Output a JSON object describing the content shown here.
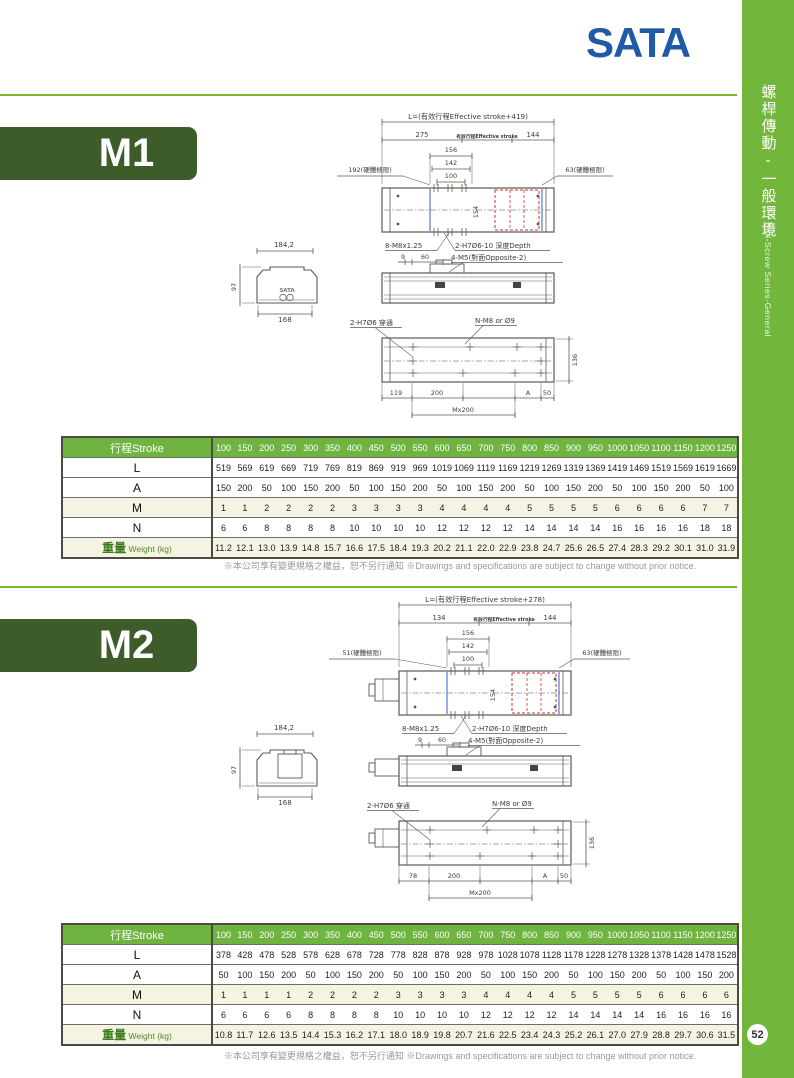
{
  "brand": {
    "logo_text": "SATA",
    "logo_color": "#1e5aa8"
  },
  "sidebar": {
    "series_title_cn": "螺桿傳動-一般環境",
    "series_title_en": "Ball-Screw Series-General",
    "page_number": "52",
    "bg_color": "#72b63c"
  },
  "footnote": "※本公司享有變更規格之權益，恕不另行通知 ※Drawings and specifications are subject to change without prior notice.",
  "table": {
    "header_label": "行程Stroke",
    "stroke_columns": [
      "100",
      "150",
      "200",
      "250",
      "300",
      "350",
      "400",
      "450",
      "500",
      "550",
      "600",
      "650",
      "700",
      "750",
      "800",
      "850",
      "900",
      "950",
      "1000",
      "1050",
      "1100",
      "1150",
      "1200",
      "1250"
    ],
    "weight_label_cn": "重量",
    "weight_label_en": "Weight (kg)"
  },
  "sections": [
    {
      "model": "M1",
      "drawing": {
        "overall_length": "L=(有效行程Effective stroke+419)",
        "front_offset": "275",
        "effective_stroke": "有效行程Effective stroke",
        "rear_offset": "144",
        "carriage_156": "156",
        "carriage_142": "142",
        "carriage_100": "100",
        "left_hard_limit": "192(硬體極限)",
        "right_hard_limit": "63(硬體極限)",
        "width_154": "154",
        "screws_8m8": "8-M8x1.25",
        "pin_holes_depth": "2-H7Ø6-10 深度Depth",
        "dim_9": "9",
        "dim_60": "60",
        "side_screws": "4-M5(對面Opposite-2)",
        "section_width": "184,2",
        "section_height": "97",
        "section_base": "168",
        "brand_mark": "SATA",
        "pin_through": "2-H7Ø6 穿通",
        "mount_holes": "N-M8 or Ø9",
        "base_width_136": "136",
        "first_hole": "119",
        "pitch_200": "200",
        "dim_A": "A",
        "dim_50": "50",
        "pitch_total": "Mx200"
      },
      "rows": [
        {
          "label": "L",
          "values": [
            519,
            569,
            619,
            669,
            719,
            769,
            819,
            869,
            919,
            969,
            1019,
            1069,
            1119,
            1169,
            1219,
            1269,
            1319,
            1369,
            1419,
            1469,
            1519,
            1569,
            1619,
            1669
          ]
        },
        {
          "label": "A",
          "values": [
            150,
            200,
            50,
            100,
            150,
            200,
            50,
            100,
            150,
            200,
            50,
            100,
            150,
            200,
            50,
            100,
            150,
            200,
            50,
            100,
            150,
            200,
            50,
            100
          ]
        },
        {
          "label": "M",
          "values": [
            1,
            1,
            2,
            2,
            2,
            2,
            3,
            3,
            3,
            3,
            4,
            4,
            4,
            4,
            5,
            5,
            5,
            5,
            6,
            6,
            6,
            6,
            7,
            7
          ]
        },
        {
          "label": "N",
          "values": [
            6,
            6,
            8,
            8,
            8,
            8,
            10,
            10,
            10,
            10,
            12,
            12,
            12,
            12,
            14,
            14,
            14,
            14,
            16,
            16,
            16,
            16,
            18,
            18
          ]
        },
        {
          "label": "weight",
          "values": [
            "11.2",
            "12.1",
            "13.0",
            "13.9",
            "14.8",
            "15.7",
            "16.6",
            "17.5",
            "18.4",
            "19.3",
            "20.2",
            "21.1",
            "22.0",
            "22.9",
            "23.8",
            "24.7",
            "25.6",
            "26.5",
            "27.4",
            "28.3",
            "29.2",
            "30.1",
            "31.0",
            "31.9"
          ]
        }
      ]
    },
    {
      "model": "M2",
      "drawing": {
        "overall_length": "L=(有效行程Effective stroke+278)",
        "front_offset": "134",
        "effective_stroke": "有效行程Effective stroke",
        "rear_offset": "144",
        "carriage_156": "156",
        "carriage_142": "142",
        "carriage_100": "100",
        "left_hard_limit": "51(硬體極限)",
        "right_hard_limit": "63(硬體極限)",
        "width_154": "154",
        "screws_8m8": "8-M8x1.25",
        "pin_holes_depth": "2-H7Ø6-10 深度Depth",
        "dim_9": "9",
        "dim_60": "60",
        "side_screws": "4-M5(對面Opposite-2)",
        "section_width": "184,2",
        "section_height": "97",
        "section_base": "168",
        "pin_through": "2-H7Ø6 穿通",
        "mount_holes": "N-M8 or Ø9",
        "base_width_136": "136",
        "first_hole": "78",
        "pitch_200": "200",
        "dim_A": "A",
        "dim_50": "50",
        "pitch_total": "Mx200"
      },
      "rows": [
        {
          "label": "L",
          "values": [
            378,
            428,
            478,
            528,
            578,
            628,
            678,
            728,
            778,
            828,
            878,
            928,
            978,
            1028,
            1078,
            1128,
            1178,
            1228,
            1278,
            1328,
            1378,
            1428,
            1478,
            1528
          ]
        },
        {
          "label": "A",
          "values": [
            50,
            100,
            150,
            200,
            50,
            100,
            150,
            200,
            50,
            100,
            150,
            200,
            50,
            100,
            150,
            200,
            50,
            100,
            150,
            200,
            50,
            100,
            150,
            200
          ]
        },
        {
          "label": "M",
          "values": [
            1,
            1,
            1,
            1,
            2,
            2,
            2,
            2,
            3,
            3,
            3,
            3,
            4,
            4,
            4,
            4,
            5,
            5,
            5,
            5,
            6,
            6,
            6,
            6
          ]
        },
        {
          "label": "N",
          "values": [
            6,
            6,
            6,
            6,
            8,
            8,
            8,
            8,
            10,
            10,
            10,
            10,
            12,
            12,
            12,
            12,
            14,
            14,
            14,
            14,
            16,
            16,
            16,
            16
          ]
        },
        {
          "label": "weight",
          "values": [
            "10.8",
            "11.7",
            "12.6",
            "13.5",
            "14.4",
            "15.3",
            "16.2",
            "17.1",
            "18.0",
            "18.9",
            "19.8",
            "20.7",
            "21.6",
            "22.5",
            "23.4",
            "24.3",
            "25.2",
            "26.1",
            "27.0",
            "27.9",
            "28.8",
            "29.7",
            "30.6",
            "31.5"
          ]
        }
      ]
    }
  ]
}
